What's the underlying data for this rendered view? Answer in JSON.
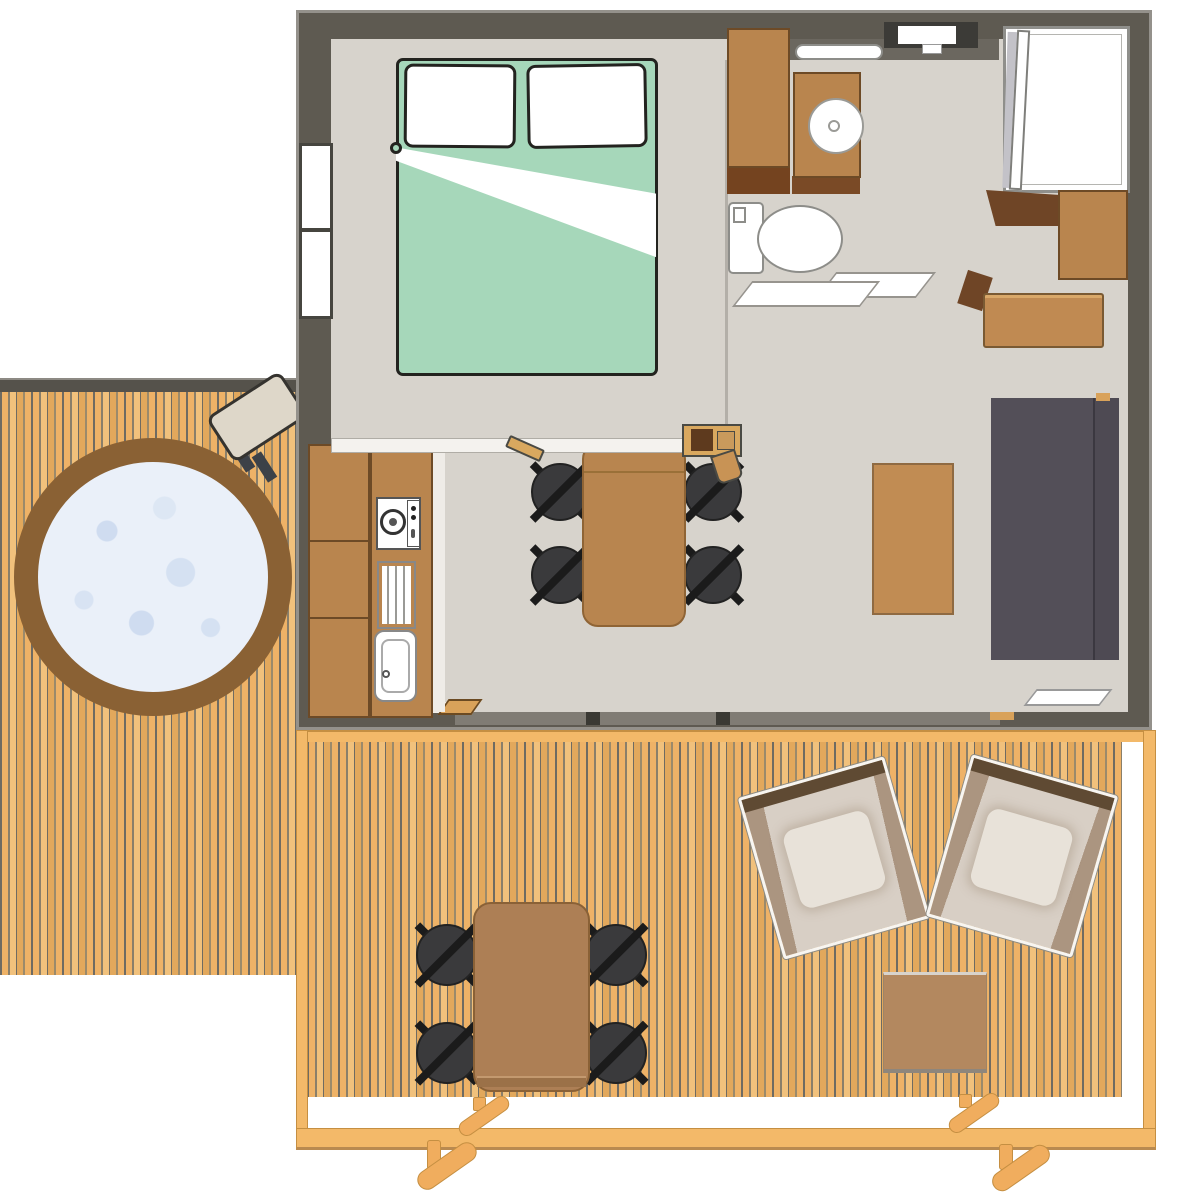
{
  "meta": {
    "title": "Cabin lodge floor plan — top view",
    "description": "Architectural top-down plan of a one-bedroom cabin with bathroom, kitchen-living room, side deck with hot tub and front wooden terrace"
  },
  "palette": {
    "wall": "#5e5a51",
    "wall_edge": "#94918b",
    "floor": "#d7d3cc",
    "bulkhead": "#6b675f",
    "wood": "#b9854e",
    "wood_dark": "#6d4a26",
    "wood_deep": "#74431f",
    "table_brown": "#b8854f",
    "coffee_brown": "#c18c53",
    "sofa": "#534f58",
    "chair": "#3a3a3c",
    "chair_leg": "#1b1b1b",
    "bed_green": "#a6d7ba",
    "ink": "#23231f",
    "plank_light": "#eeb267",
    "plank_mid": "#e2a85c",
    "plank_dark": "#6f6b62",
    "rail": "#f3b969",
    "rail_edge": "#c58f42",
    "tub_ring": "#8a6134",
    "water": "#eaf0f9",
    "water_speckle": "#cfdcf0",
    "lounge_beige": "#d8cfc5",
    "lounge_shadow": "#ab9580",
    "lounge_bar": "#5f4a33",
    "side_table": "#b3885f",
    "deck_border": "#55524b",
    "track": "#807c74"
  },
  "rooms": {
    "bedroom": "Bedroom with double bed",
    "bathroom": "Bathroom with sink, toilet and shower",
    "living": "Living room with sofa and dining table",
    "kitchen": "Kitchenette with hob and sink",
    "deck_left": "Side deck with hot tub",
    "terrace": "Front wooden terrace"
  },
  "items": {
    "building": "Cabin building",
    "floor": "Interior floor",
    "bed": "Double bed with green duvet",
    "pillow": "Pillow",
    "window_left": "Bedroom window",
    "window_top": "Bathroom window",
    "wardrobe": "Wardrobe cabinet",
    "shelf_dark": "Dark wood shelf",
    "sink_unit": "Bathroom sink cabinet",
    "basin": "Round wash basin",
    "towel_bar": "Towel bar",
    "toilet": "Toilet",
    "shower": "Shower cabin",
    "corner_cabinet": "Corner cabinet",
    "right_cabinet": "Storage cabinet",
    "bathroom_door": "Bathroom sliding door",
    "bench": "Wooden bench",
    "sofa": "Sofa",
    "coffee_table": "Coffee table",
    "tray": "Wall shelf",
    "dining_table": "Dining table",
    "dining_chair": "Dining chair",
    "kitchen_counter": "Kitchen counter",
    "hob": "Gas hob",
    "drainer": "Draining board",
    "kitchen_sink": "Kitchen sink",
    "half_wall": "Partition half-wall",
    "stove": "Small wood stove",
    "sliding_door": "Sliding glass door",
    "hot_tub": "Hot tub",
    "tub_table": "Hot tub side table",
    "terrace": "Wooden terrace",
    "railing": "Terrace railing",
    "terrace_leg": "Terrace support leg",
    "outdoor_table": "Outdoor dining table",
    "outdoor_chair": "Outdoor chair",
    "lounge_chair": "Lounge deck chair",
    "side_table": "Outdoor side table"
  }
}
